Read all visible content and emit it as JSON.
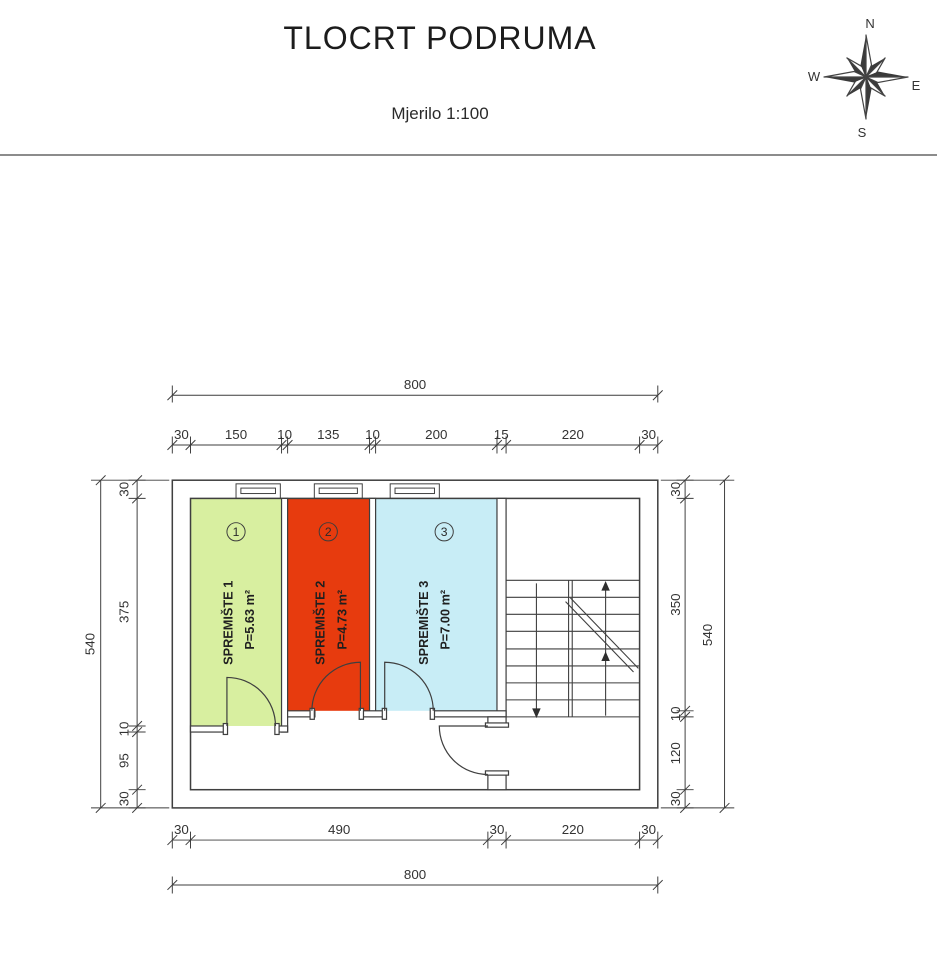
{
  "header": {
    "title": "TLOCRT PODRUMA",
    "subtitle": "Mjerilo 1:100"
  },
  "compass": {
    "n": "N",
    "e": "E",
    "s": "S",
    "w": "W"
  },
  "rooms": [
    {
      "number": "1",
      "name": "SPREMIŠTE 1",
      "area": "P=5.63 m²",
      "color": "#d8efa0"
    },
    {
      "number": "2",
      "name": "SPREMIŠTE 2",
      "area": "P=4.73 m²",
      "color": "#e73b0e"
    },
    {
      "number": "3",
      "name": "SPREMIŠTE 3",
      "area": "P=7.00 m²",
      "color": "#c8edf6"
    }
  ],
  "dimensions": {
    "top_total": "800",
    "bottom_total": "800",
    "left_total": "540",
    "right_total": "540",
    "top_chain": [
      "30",
      "150",
      "10",
      "135",
      "10",
      "200",
      "15",
      "220",
      "30"
    ],
    "bottom_chain": [
      "30",
      "490",
      "30",
      "220",
      "30"
    ],
    "left_chain": [
      "30",
      "375",
      "10",
      "95",
      "30"
    ],
    "right_chain": [
      "30",
      "350",
      "10",
      "120",
      "30"
    ]
  }
}
